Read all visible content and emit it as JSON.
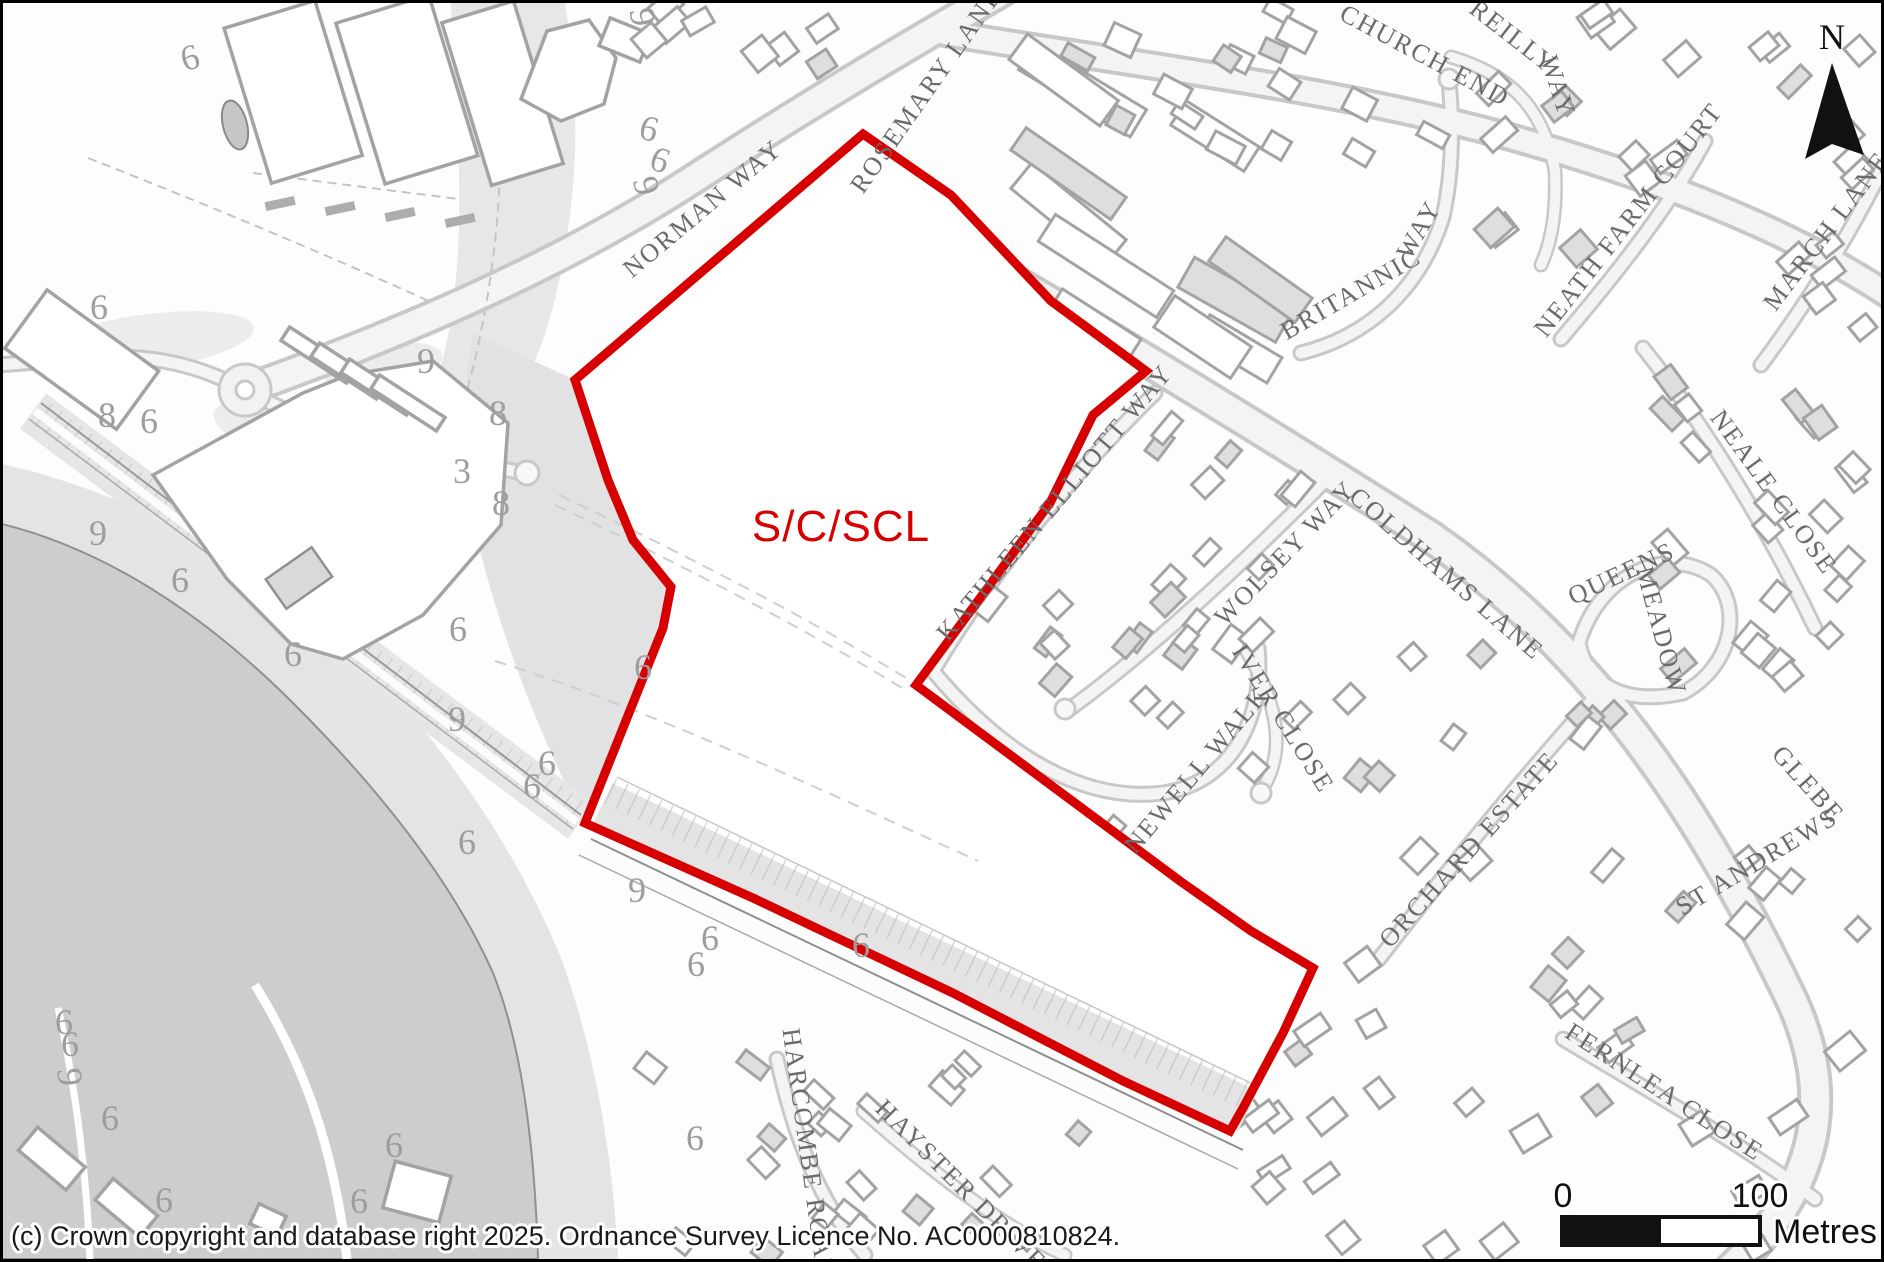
{
  "site": {
    "label": "S/C/SCL",
    "boundary_color": "#d60000"
  },
  "north_arrow": {
    "label": "N"
  },
  "scale_bar": {
    "zero": "0",
    "hundred": "100",
    "unit": "Metres"
  },
  "copyright": "(c) Crown copyright and database right 2025. Ordnance Survey Licence No. AC0000810824.",
  "street_labels": [
    {
      "text": "NORMAN WAY",
      "x": 705,
      "y": 212,
      "rot": -40
    },
    {
      "text": "ROSEMARY LANE",
      "x": 930,
      "y": 92,
      "rot": -55
    },
    {
      "text": "CHURCH END",
      "x": 1418,
      "y": 60,
      "rot": 28
    },
    {
      "text": "REILLY",
      "x": 1505,
      "y": 40,
      "rot": 38
    },
    {
      "text": "WAY",
      "x": 1547,
      "y": 86,
      "rot": 72
    },
    {
      "text": "BRITANNIC",
      "x": 1352,
      "y": 298,
      "rot": -30
    },
    {
      "text": "WAY",
      "x": 1423,
      "y": 231,
      "rot": -60
    },
    {
      "text": "NEATH FARM COURT",
      "x": 1632,
      "y": 222,
      "rot": -52
    },
    {
      "text": "MARCH LANE",
      "x": 1830,
      "y": 233,
      "rot": -53
    },
    {
      "text": "COLDHAMS LANE",
      "x": 1438,
      "y": 577,
      "rot": 41
    },
    {
      "text": "KATHLEEN ELLIOTT WAY",
      "x": 1058,
      "y": 505,
      "rot": -50
    },
    {
      "text": "WOLSEY WAY",
      "x": 1288,
      "y": 556,
      "rot": -46
    },
    {
      "text": "NEALE CLOSE",
      "x": 1764,
      "y": 494,
      "rot": 54
    },
    {
      "text": "QUEENS",
      "x": 1622,
      "y": 578,
      "rot": -25
    },
    {
      "text": "MEADOW",
      "x": 1650,
      "y": 630,
      "rot": 75
    },
    {
      "text": "IVER CLOSE",
      "x": 1273,
      "y": 720,
      "rot": 58
    },
    {
      "text": "NEWELL WALK",
      "x": 1200,
      "y": 772,
      "rot": -50
    },
    {
      "text": "ORCHARD ESTATE",
      "x": 1472,
      "y": 852,
      "rot": -48
    },
    {
      "text": "GLEBE",
      "x": 1799,
      "y": 787,
      "rot": 48
    },
    {
      "text": "ST ANDREWS",
      "x": 1758,
      "y": 866,
      "rot": -31
    },
    {
      "text": "FERNLEA CLOSE",
      "x": 1657,
      "y": 1096,
      "rot": 33
    },
    {
      "text": "HARCOMBE ROAD",
      "x": 797,
      "y": 1152,
      "rot": 82
    },
    {
      "text": "HAYSTER DRIVE",
      "x": 952,
      "y": 1188,
      "rot": 45
    }
  ],
  "map_numbers": [
    {
      "t": "9",
      "x": 628,
      "y": 16,
      "rot": 80
    },
    {
      "t": "6",
      "x": 643,
      "y": 137,
      "rot": 15
    },
    {
      "t": "6",
      "x": 653,
      "y": 168,
      "rot": 20
    },
    {
      "t": "9",
      "x": 632,
      "y": 186,
      "rot": 75
    },
    {
      "t": "6",
      "x": 190,
      "y": 66,
      "rot": -15
    },
    {
      "t": "6",
      "x": 96,
      "y": 316,
      "rot": 0
    },
    {
      "t": "9",
      "x": 423,
      "y": 370,
      "rot": 0
    },
    {
      "t": "8",
      "x": 104,
      "y": 424,
      "rot": 0
    },
    {
      "t": "6",
      "x": 146,
      "y": 430,
      "rot": 0
    },
    {
      "t": "8",
      "x": 495,
      "y": 422,
      "rot": 0
    },
    {
      "t": "3",
      "x": 459,
      "y": 480,
      "rot": 0
    },
    {
      "t": "8",
      "x": 498,
      "y": 512,
      "rot": 0
    },
    {
      "t": "9",
      "x": 95,
      "y": 542,
      "rot": 0
    },
    {
      "t": "6",
      "x": 177,
      "y": 589,
      "rot": 0
    },
    {
      "t": "6",
      "x": 455,
      "y": 638,
      "rot": 0
    },
    {
      "t": "6",
      "x": 290,
      "y": 663,
      "rot": 0
    },
    {
      "t": "6",
      "x": 640,
      "y": 676,
      "rot": 0
    },
    {
      "t": "9",
      "x": 454,
      "y": 728,
      "rot": 0
    },
    {
      "t": "6",
      "x": 544,
      "y": 772,
      "rot": 0
    },
    {
      "t": "6",
      "x": 529,
      "y": 795,
      "rot": 0
    },
    {
      "t": "6",
      "x": 464,
      "y": 851,
      "rot": 0
    },
    {
      "t": "9",
      "x": 634,
      "y": 899,
      "rot": 0
    },
    {
      "t": "6",
      "x": 707,
      "y": 947,
      "rot": 0
    },
    {
      "t": "6",
      "x": 693,
      "y": 973,
      "rot": 0
    },
    {
      "t": "6",
      "x": 858,
      "y": 954,
      "rot": 0
    },
    {
      "t": "6",
      "x": 61,
      "y": 1031,
      "rot": 0
    },
    {
      "t": "6",
      "x": 67,
      "y": 1053,
      "rot": 0
    },
    {
      "t": "9",
      "x": 55,
      "y": 1075,
      "rot": 85
    },
    {
      "t": "6",
      "x": 107,
      "y": 1127,
      "rot": 0
    },
    {
      "t": "6",
      "x": 161,
      "y": 1209,
      "rot": 0
    },
    {
      "t": "6",
      "x": 391,
      "y": 1154,
      "rot": 0
    },
    {
      "t": "6",
      "x": 356,
      "y": 1210,
      "rot": 0
    },
    {
      "t": "6",
      "x": 692,
      "y": 1147,
      "rot": 0
    }
  ]
}
